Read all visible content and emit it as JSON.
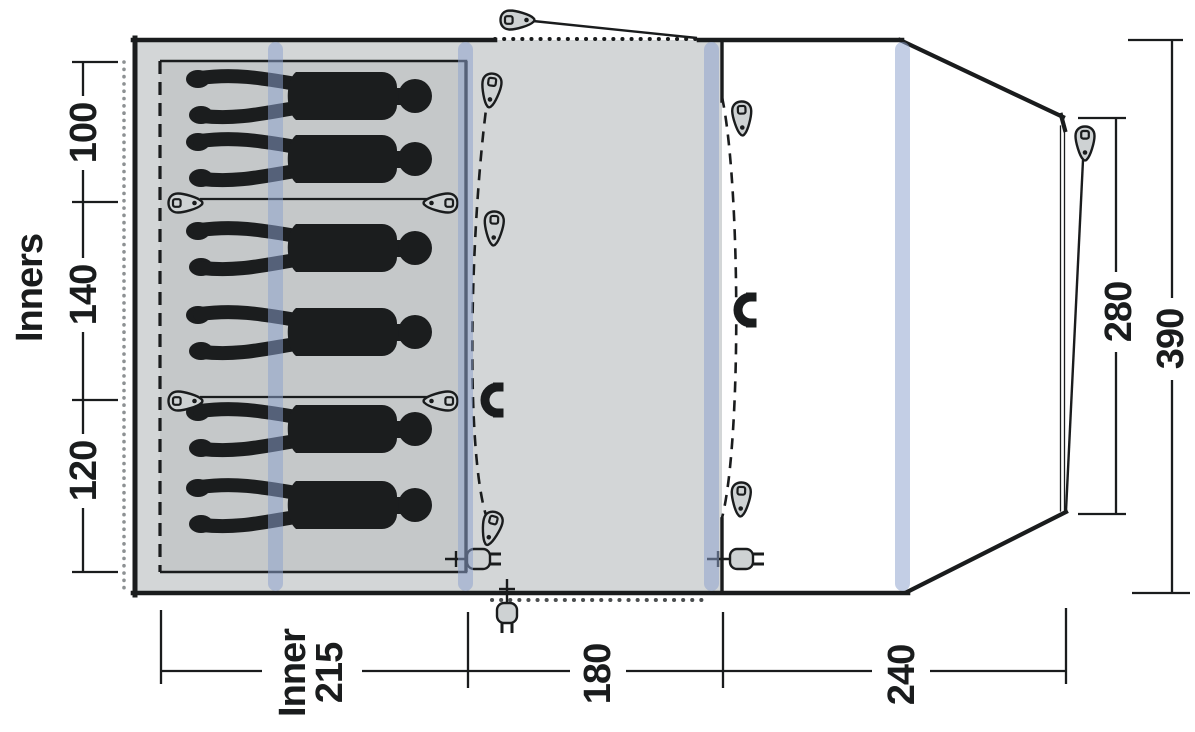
{
  "page": {
    "background": "#ffffff",
    "description": "Tent floor plan diagram, top view, with sleeping inners and dimensions in cm"
  },
  "floorplan": {
    "left_dimension": {
      "label": "Inners",
      "compartments": [
        {
          "value": "100"
        },
        {
          "value": "140"
        },
        {
          "value": "120"
        }
      ]
    },
    "bottom_dimension": {
      "sections": [
        {
          "label": "Inner",
          "value": "215"
        },
        {
          "value": "180"
        },
        {
          "value": "240"
        }
      ]
    },
    "right_dimension": {
      "values": [
        {
          "value": "280"
        },
        {
          "value": "390"
        }
      ]
    },
    "sleepers_count": 6,
    "icons": {
      "zipper_pull": "zipper-pull-icon",
      "magnet": "magnet-icon",
      "power_plug": "power-plug-icon",
      "guy_peg": "guy-peg-icon"
    },
    "colors": {
      "outline": "#1a1c1d",
      "canvas_gray": "#d3d6d7",
      "inner_cabin_gray": "#c5c8c9",
      "pole_band_blue": "#8ca2cd",
      "icon_fill": "#ced2d3",
      "figure_black": "#1b1d1e",
      "dot_gray": "#8d9193",
      "porch_white": "#ffffff"
    }
  }
}
